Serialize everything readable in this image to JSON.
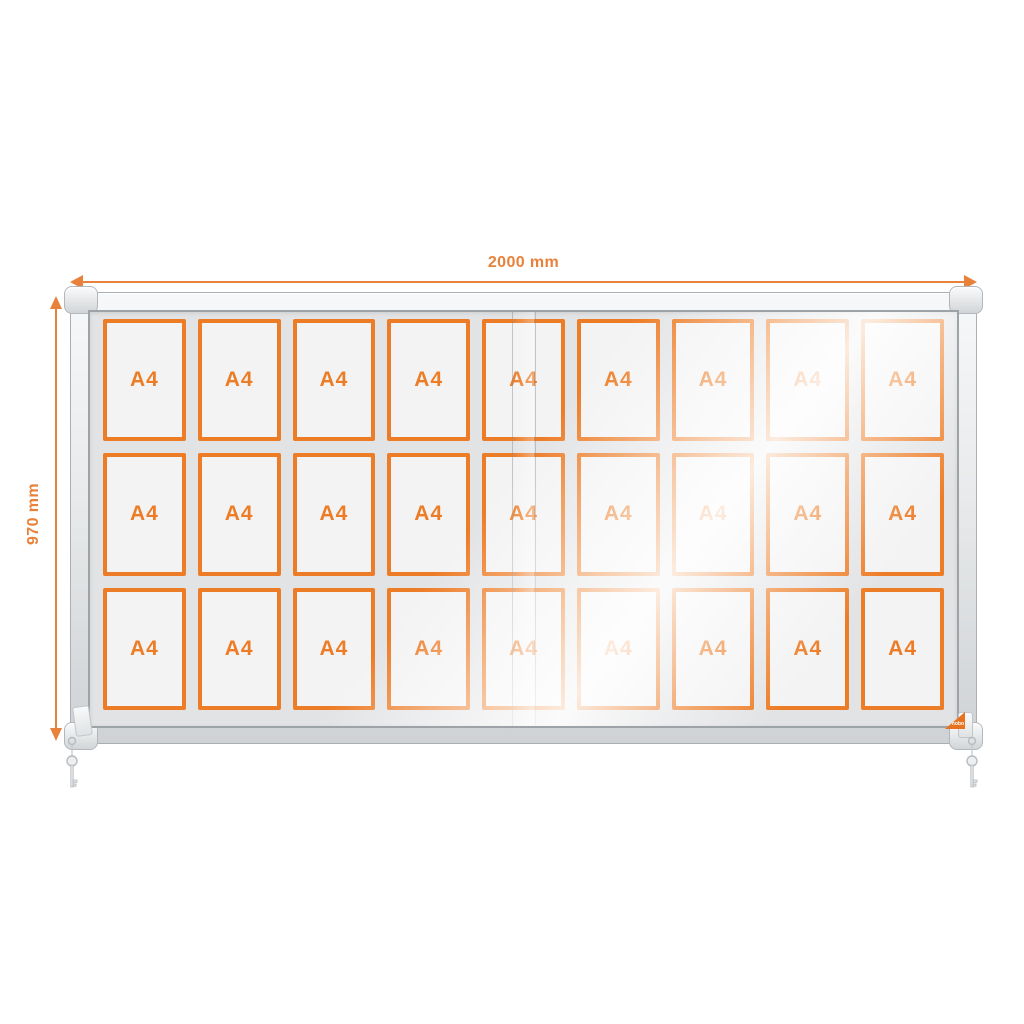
{
  "dimensions": {
    "width": {
      "label": "2000 mm"
    },
    "height": {
      "label": "970 mm"
    }
  },
  "case": {
    "grid": {
      "rows": 3,
      "columns": 9,
      "total_slots": 27,
      "slot_label": "A4"
    },
    "badge_label": "nobo",
    "doors": {
      "type": "sliding-glass",
      "seam_count": 2
    },
    "keys": {
      "left": true,
      "right": true
    }
  },
  "icons": {
    "width_arrow_left": "arrow-left-icon",
    "width_arrow_right": "arrow-right-icon",
    "height_arrow_up": "arrow-up-icon",
    "height_arrow_down": "arrow-down-icon",
    "key_left": "key-icon",
    "key_right": "key-icon"
  },
  "colors": {
    "accent_orange": "#ED7C26",
    "dimension_orange": "#E8823B",
    "badge_orange": "#E8731F",
    "frame_silver": "#D8DBDD",
    "frame_shadow": "#9EA3A7",
    "interior_gray": "#E2E3E5",
    "slot_fill": "#F3F3F4",
    "background": "#FFFFFF"
  }
}
